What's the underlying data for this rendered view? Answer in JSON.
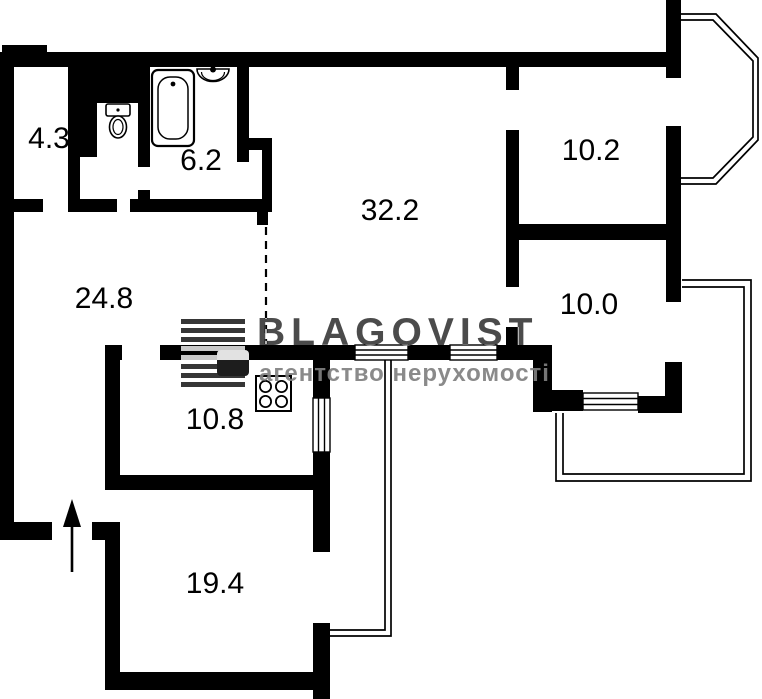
{
  "plan": {
    "watermark": {
      "brand": "BLAGOVIST",
      "tagline": "агентство нерухомості"
    },
    "rooms": [
      {
        "name": "wc",
        "area": "4.3"
      },
      {
        "name": "bathroom",
        "area": "6.2"
      },
      {
        "name": "living-room",
        "area": "32.2"
      },
      {
        "name": "bedroom-upper-right",
        "area": "10.2"
      },
      {
        "name": "hallway",
        "area": "24.8"
      },
      {
        "name": "room-right",
        "area": "10.0"
      },
      {
        "name": "kitchen",
        "area": "10.8"
      },
      {
        "name": "room-bottom",
        "area": "19.4"
      }
    ],
    "fixtures": [
      "bathtub-icon",
      "sink-icon",
      "toilet-icon",
      "stove-icon",
      "entrance-arrow-icon",
      "bay-window",
      "balcony-right",
      "balcony-left",
      "window-icon"
    ],
    "colors": {
      "wall": "#000000",
      "background": "#ffffff",
      "watermark_brand_on_white": "#4a4a4a",
      "watermark_tagline_on_white": "#8a8a8a"
    }
  }
}
